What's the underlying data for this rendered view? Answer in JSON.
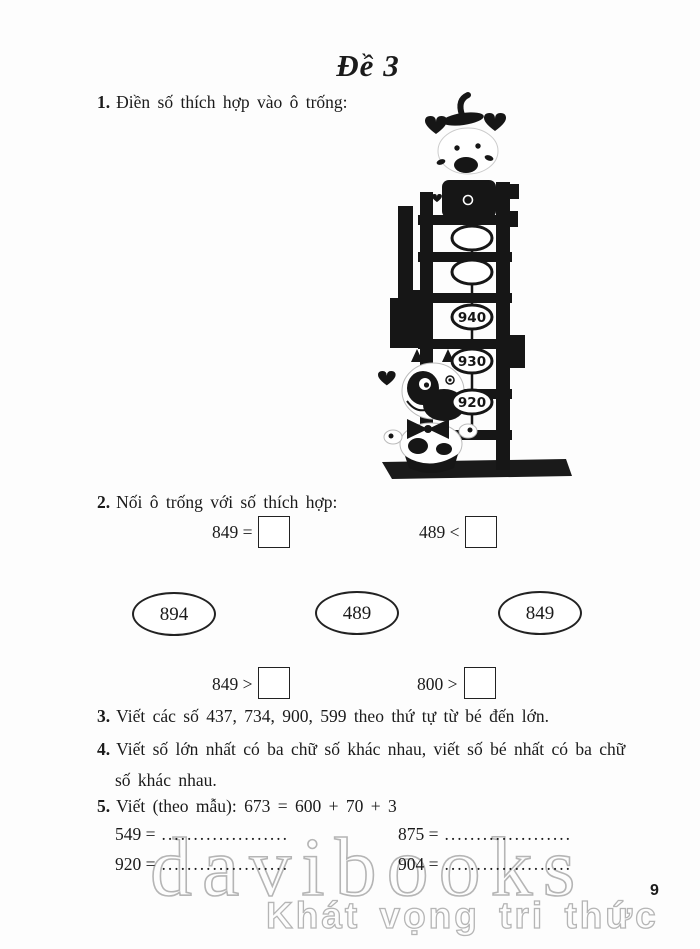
{
  "title": "Đề 3",
  "page_number": "9",
  "watermark": {
    "brand": "davibooks",
    "slogan": "Khát vọng tri thức"
  },
  "colors": {
    "ink": "#1b1b1b",
    "watermark_gray": "#b5b5b5",
    "paper": "#fdfdfd"
  },
  "questions": {
    "q1": {
      "num": "1.",
      "text": "Điền số thích hợp vào ô trống:"
    },
    "q2": {
      "num": "2.",
      "text": "Nối ô trống với số thích hợp:"
    },
    "q3": {
      "num": "3.",
      "text": "Viết các số 437, 734, 900, 599 theo thứ tự từ bé đến lớn."
    },
    "q4": {
      "num": "4.",
      "line1": "Viết số lớn nhất có ba chữ số khác nhau, viết số bé nhất có ba chữ",
      "line2": "số khác nhau."
    },
    "q5": {
      "num": "5.",
      "text": "Viết (theo mẫu): 673 = 600 + 70 + 3"
    }
  },
  "ladder": {
    "labels": [
      "",
      "",
      "940",
      "930",
      "920"
    ]
  },
  "matching": {
    "top_left": "849 =",
    "top_right": "489 <",
    "ovals": [
      "894",
      "489",
      "849"
    ],
    "bottom_left": "849 >",
    "bottom_right": "800 >"
  },
  "expansion_rows": [
    {
      "left": "549 =",
      "left_dots": "....................",
      "right": "875 =",
      "right_dots": "...................."
    },
    {
      "left": "920 =",
      "left_dots": "....................",
      "right": "904 =",
      "right_dots": "...................."
    }
  ]
}
